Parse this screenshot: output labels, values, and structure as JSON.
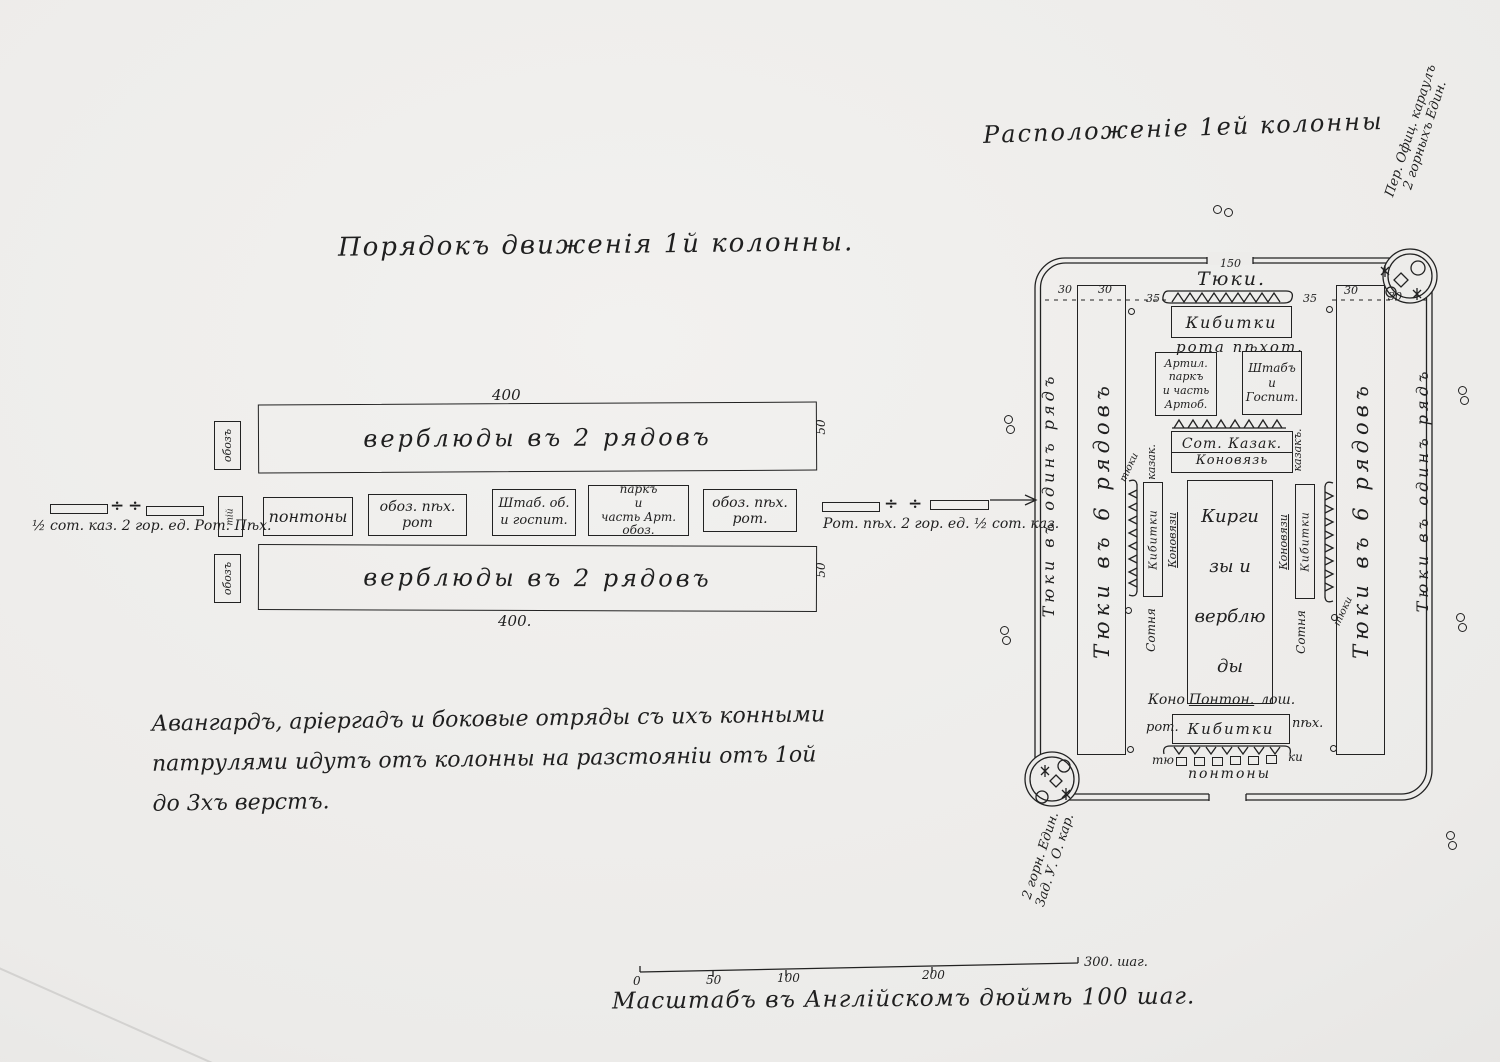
{
  "march": {
    "title": "Порядокъ движенія 1й колонны.",
    "divider": "÷",
    "camel_top": {
      "label": "верблюды въ 2 рядовъ",
      "length": "400",
      "depth": "50",
      "side": "обозъ"
    },
    "camel_bottom": {
      "label": "верблюды въ 2 рядовъ",
      "length": "400.",
      "depth": "50",
      "side": "обозъ"
    },
    "mid": {
      "side": "тій",
      "boxes": [
        "понтоны",
        "обоз. пѣх. рот",
        "Штаб. об.\nи госпит.",
        "паркъ\nи\nчасть Арт. обоз.",
        "обоз. пѣх. рот."
      ]
    },
    "left_flank_label": "½ сот. каз. 2 гор. ед. Рот. Пѣх.",
    "right_flank_label": "Рот. пѣх. 2 гор. ед. ½ сот. каз.",
    "note": "Авангардъ, аріергадъ и боковые отряды съ ихъ конными\nпатрулями идутъ отъ колонны на разстояніи отъ 1ой\nдо 3хъ верстъ."
  },
  "camp": {
    "title": "Расположеніе 1ей колонны",
    "guard_front": "Пер. Офиц. караулъ\n2 горныхъ Един.",
    "guard_rear": "2 горн. Един.\nЗад. У. О. кар.",
    "measures": [
      "30",
      "30",
      "35",
      "35",
      "30",
      "30"
    ],
    "top": {
      "len": "150",
      "bales": "Тюки.",
      "kibitki": "Кибитки",
      "kibitki_sub": "рота пѣхот."
    },
    "left_wall": "Тюки въ одинъ рядъ",
    "right_wall": "Тюки въ одинъ рядъ",
    "left_column": "Тюки въ 6 рядовъ",
    "right_column": "Тюки въ 6 рядовъ",
    "artillery": "Артил.\nпаркъ\nи часть\nАртоб.",
    "staff": "Штабъ\nи\nГоспит.",
    "cossack_box": {
      "line1": "Сот. Казак.",
      "line2": "Коновязь"
    },
    "center": "Кирги\nзы и\nверблю\nды",
    "left_group": {
      "top": "казак.",
      "box": "Кибитки",
      "bottom": "Сотня",
      "line": "Коновязи",
      "tip": "тюки"
    },
    "right_group": {
      "top": "казакъ.",
      "box": "Кибитки",
      "bottom": "Сотня",
      "line": "Коновязи",
      "tip": "тюки"
    },
    "bottom": {
      "horse_a": "Коно",
      "horse_b": "Понтон.",
      "horse_c": "лош.",
      "kibitki": "Кибитки",
      "rot": "рот.",
      "pih": "пѣх.",
      "tyu": "тю",
      "ki": "ки",
      "pontoons": "понтоны"
    }
  },
  "scale": {
    "ticks": [
      "0",
      "50",
      "100",
      "200"
    ],
    "end": "300. шаг.",
    "caption": "Масштабъ въ Англійскомъ дюймѣ 100 шаг."
  }
}
